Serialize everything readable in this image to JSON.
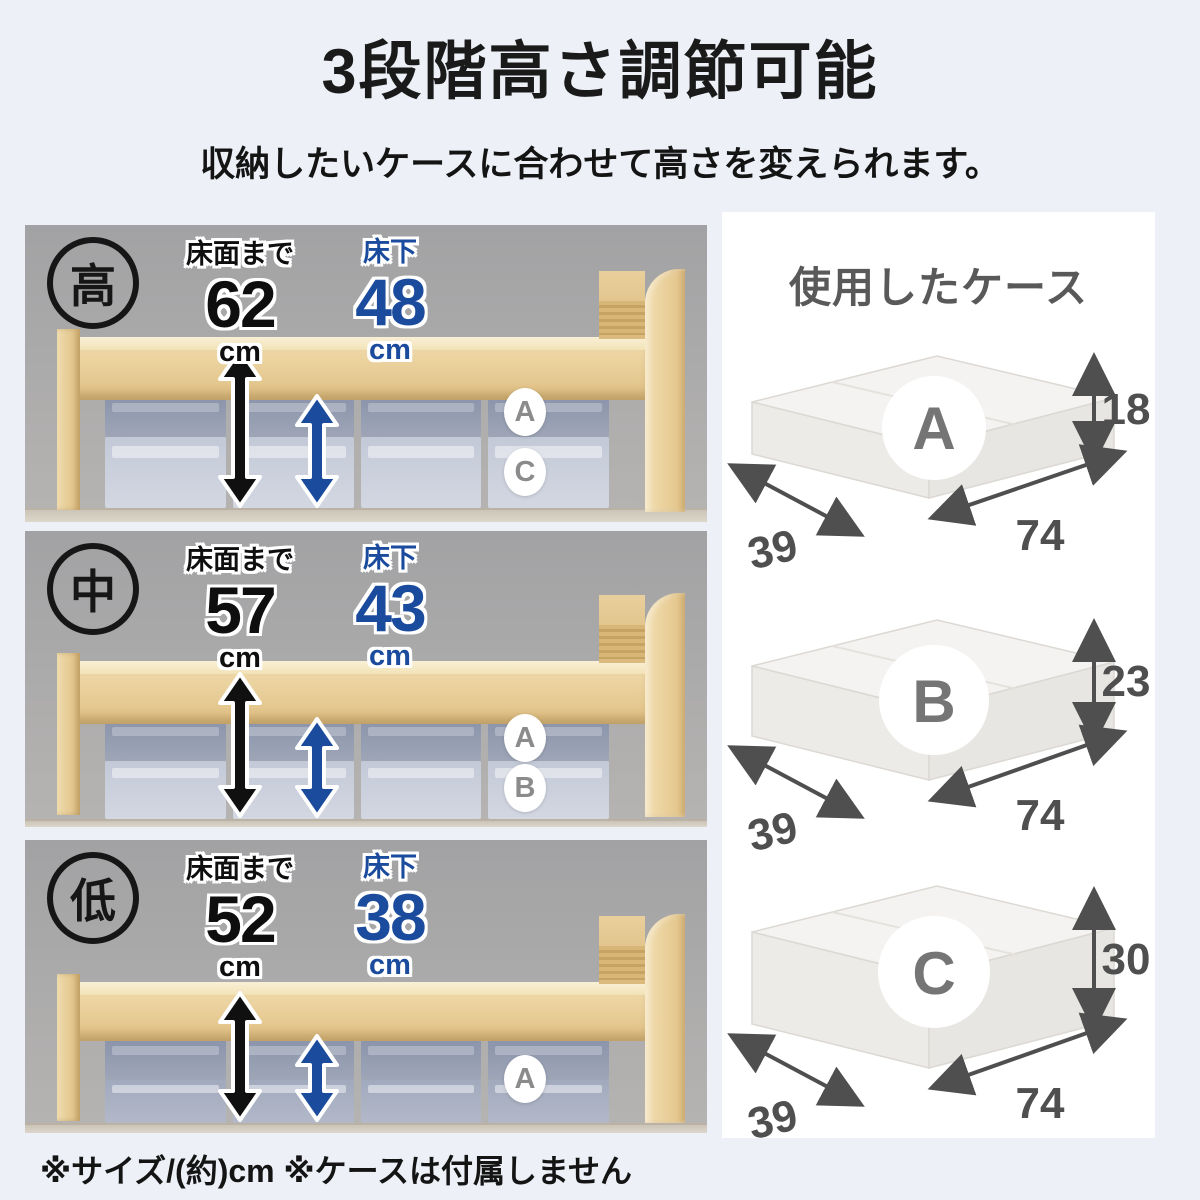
{
  "page": {
    "title": "3段階高さ調節可能",
    "subtitle": "収納したいケースに合わせて高さを変えられます。",
    "footnote": "※サイズ/(約)cm ※ケースは付属しません"
  },
  "colors": {
    "background": "#edf1f7",
    "accent_blue": "#1b4b9d",
    "text_black": "#141414",
    "dim_gray": "#4f4f4f",
    "card_white": "#ffffff"
  },
  "bed_panels": [
    {
      "badge": "高",
      "floor_label": "床面まで",
      "floor_value": "62",
      "floor_unit": "cm",
      "under_label": "床下",
      "under_value": "48",
      "under_unit": "cm",
      "cases": [
        "A",
        "C"
      ]
    },
    {
      "badge": "中",
      "floor_label": "床面まで",
      "floor_value": "57",
      "floor_unit": "cm",
      "under_label": "床下",
      "under_value": "43",
      "under_unit": "cm",
      "cases": [
        "A",
        "B"
      ]
    },
    {
      "badge": "低",
      "floor_label": "床面まで",
      "floor_value": "52",
      "floor_unit": "cm",
      "under_label": "床下",
      "under_value": "38",
      "under_unit": "cm",
      "cases": [
        "A"
      ]
    }
  ],
  "case_panel": {
    "heading": "使用したケース",
    "cases": [
      {
        "letter": "A",
        "height": "18",
        "width": "74",
        "depth": "39"
      },
      {
        "letter": "B",
        "height": "23",
        "width": "74",
        "depth": "39"
      },
      {
        "letter": "C",
        "height": "30",
        "width": "74",
        "depth": "39"
      }
    ]
  }
}
